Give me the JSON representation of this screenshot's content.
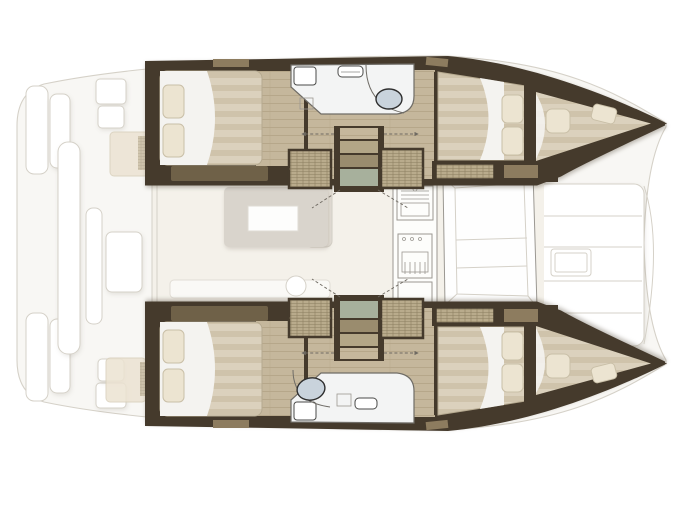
{
  "plan": {
    "description": "Catamaran yacht interior floor plan, top view, bow pointing right",
    "orientation": "bow-right",
    "hulls": [
      {
        "name": "port hull (top)",
        "rooms": [
          "aft double cabin",
          "head with basin",
          "companionway steps",
          "forward double cabin",
          "forepeak berth"
        ]
      },
      {
        "name": "starboard hull (bottom)",
        "rooms": [
          "aft double cabin",
          "head with basin",
          "companionway steps",
          "forward double cabin",
          "forepeak berth"
        ]
      }
    ],
    "saloon": [
      "dining table",
      "settee",
      "galley with sink and stove",
      "forward sofa"
    ],
    "deck": [
      "aft cockpit with benches",
      "transom steps",
      "solid foredeck with deck hatch"
    ],
    "counts": {
      "double_berths": 4,
      "forepeak_berths": 2,
      "heads": 2,
      "companionways": 2
    }
  },
  "colors": {
    "wall_dark": "#453a2c",
    "wall_mid": "#8d7c5f",
    "wood_floor": "#c5b79c",
    "wood_floor_dark": "#b2a285",
    "mattress": "#dbd1bd",
    "mattress_stripe": "#cfc3ab",
    "mattress_edge": "#b5a98f",
    "pillow": "#ece4d1",
    "pillow_border": "#c9bfa7",
    "sheet_white": "#f4f3f0",
    "wicker": "#b9ab8c",
    "wicker_line": "#8c7f60",
    "locker_olive": "#6f6148",
    "step_green": "#a7b09c",
    "step_tan": "#b3a687",
    "step_tan_dark": "#9a8c6e",
    "bath_floor": "#f3f4f4",
    "bath_stroke": "#6f6c66",
    "sink_fill": "#c9d3dc",
    "sink_stroke": "#2e2e2e",
    "saloon_floor": "#f4f1ea",
    "table_fill": "#d9d4cc",
    "ghost_stroke": "#d5d1c8",
    "ghost_fill": "#f8f7f4",
    "galley_stroke": "#9b9892"
  }
}
